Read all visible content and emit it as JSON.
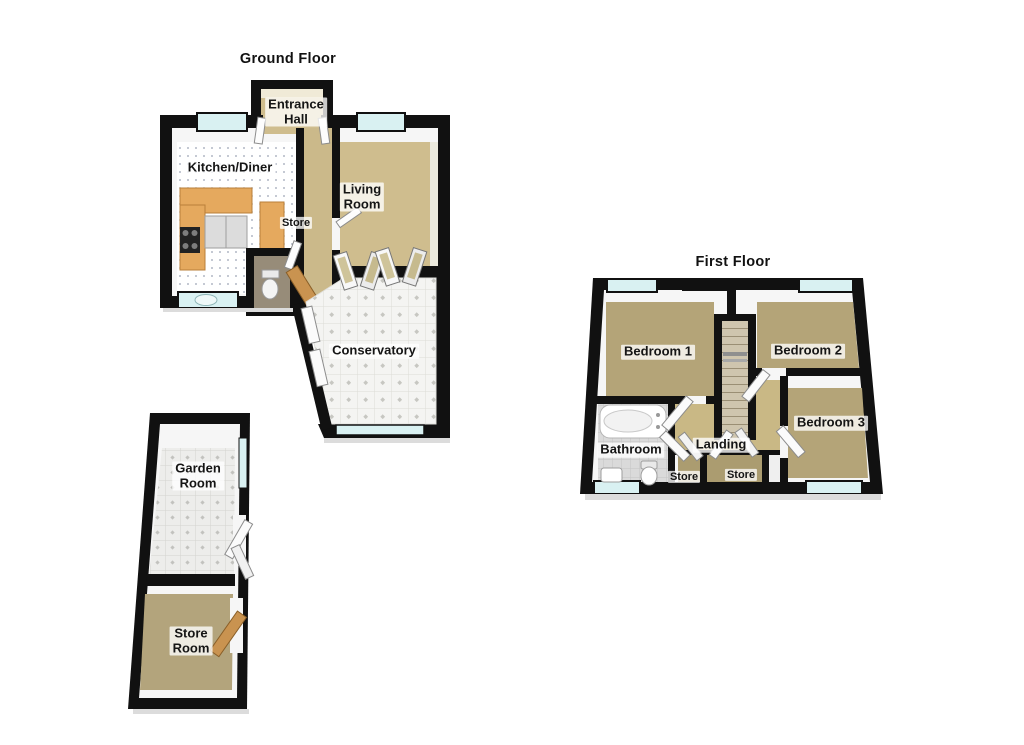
{
  "ground_floor": {
    "title": "Ground Floor",
    "labels": {
      "entrance_hall": "Entrance\nHall",
      "kitchen_diner": "Kitchen/Diner",
      "living_room": "Living\nRoom",
      "store": "Store",
      "conservatory": "Conservatory"
    }
  },
  "outbuilding": {
    "labels": {
      "garden_room": "Garden\nRoom",
      "store_room": "Store\nRoom"
    }
  },
  "first_floor": {
    "title": "First Floor",
    "labels": {
      "bedroom_1": "Bedroom 1",
      "bedroom_2": "Bedroom 2",
      "bedroom_3": "Bedroom 3",
      "bathroom": "Bathroom",
      "landing": "Landing",
      "store_left": "Store",
      "store_right": "Store"
    }
  },
  "colors": {
    "wall": "#111111",
    "window_glass": "#d9f1f2",
    "floor_tan_light": "#cfbd8e",
    "floor_tan_bedroom": "#b4a478",
    "floor_tan_store": "#ab9c70",
    "kitchen_counter": "#e5a95e",
    "wood_door": "#c99350",
    "tile_white": "#f4f4f2",
    "bath_tile": "#dadada"
  }
}
